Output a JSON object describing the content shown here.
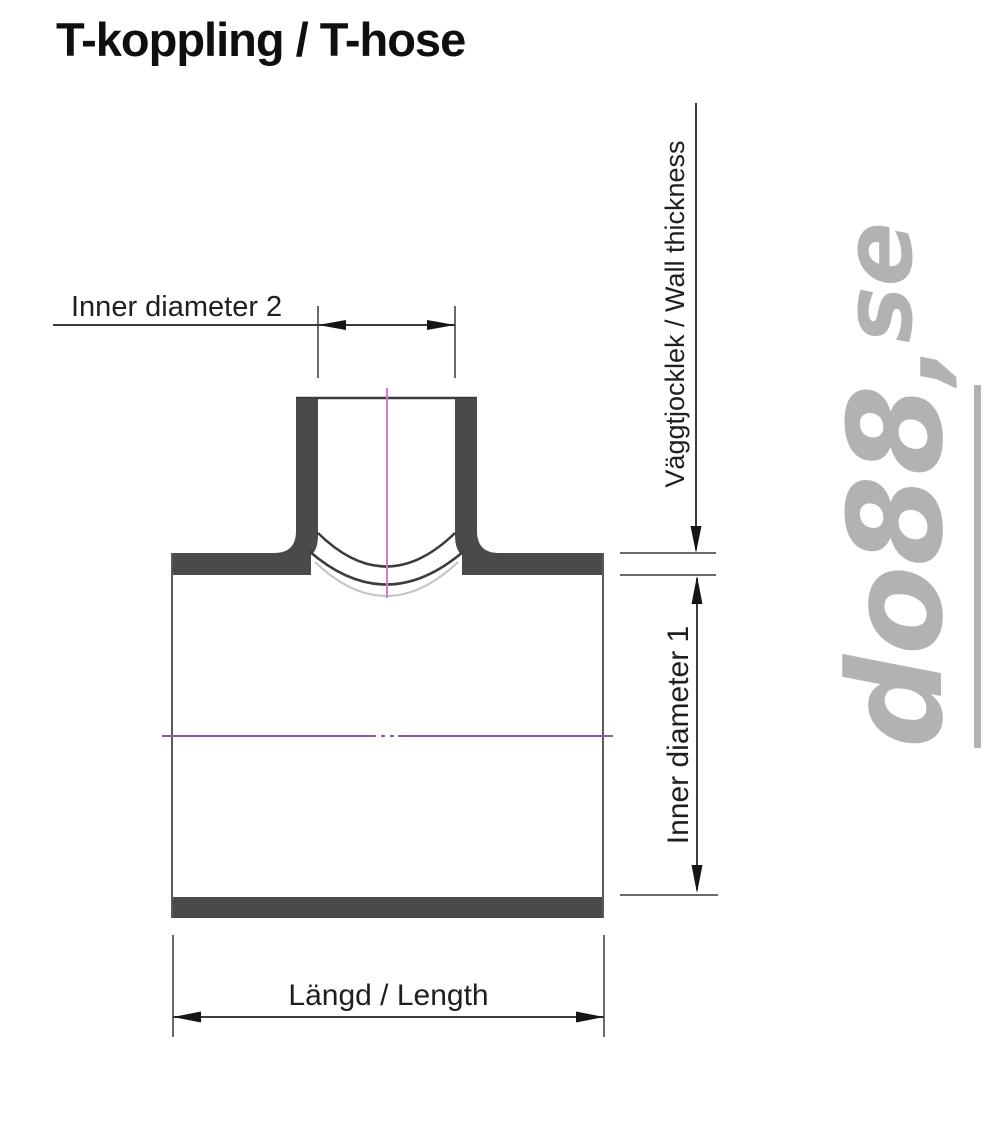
{
  "page": {
    "title": "T-koppling / T-hose"
  },
  "drawing": {
    "type": "technical-cross-section",
    "subject": "T-coupling hose",
    "labels": {
      "inner_diameter_2": "Inner diameter 2",
      "wall_thickness": "Väggtjocklek / Wall thickness",
      "inner_diameter_1": "Inner diameter 1",
      "length": "Längd / Length"
    },
    "colors": {
      "wall_fill": "#4a4a4a",
      "outline": "#3c3c3c",
      "extension_line": "#6a6a6a",
      "arrow": "#161616",
      "centerline_vertical": "#d678d6",
      "centerline_horizontal": "#8a5ca8",
      "saddle_highlight": "#c4c4c4",
      "watermark": "#b2b2b2"
    }
  },
  "watermark": {
    "brand": "do88",
    "separator": ",",
    "tld": "se"
  }
}
